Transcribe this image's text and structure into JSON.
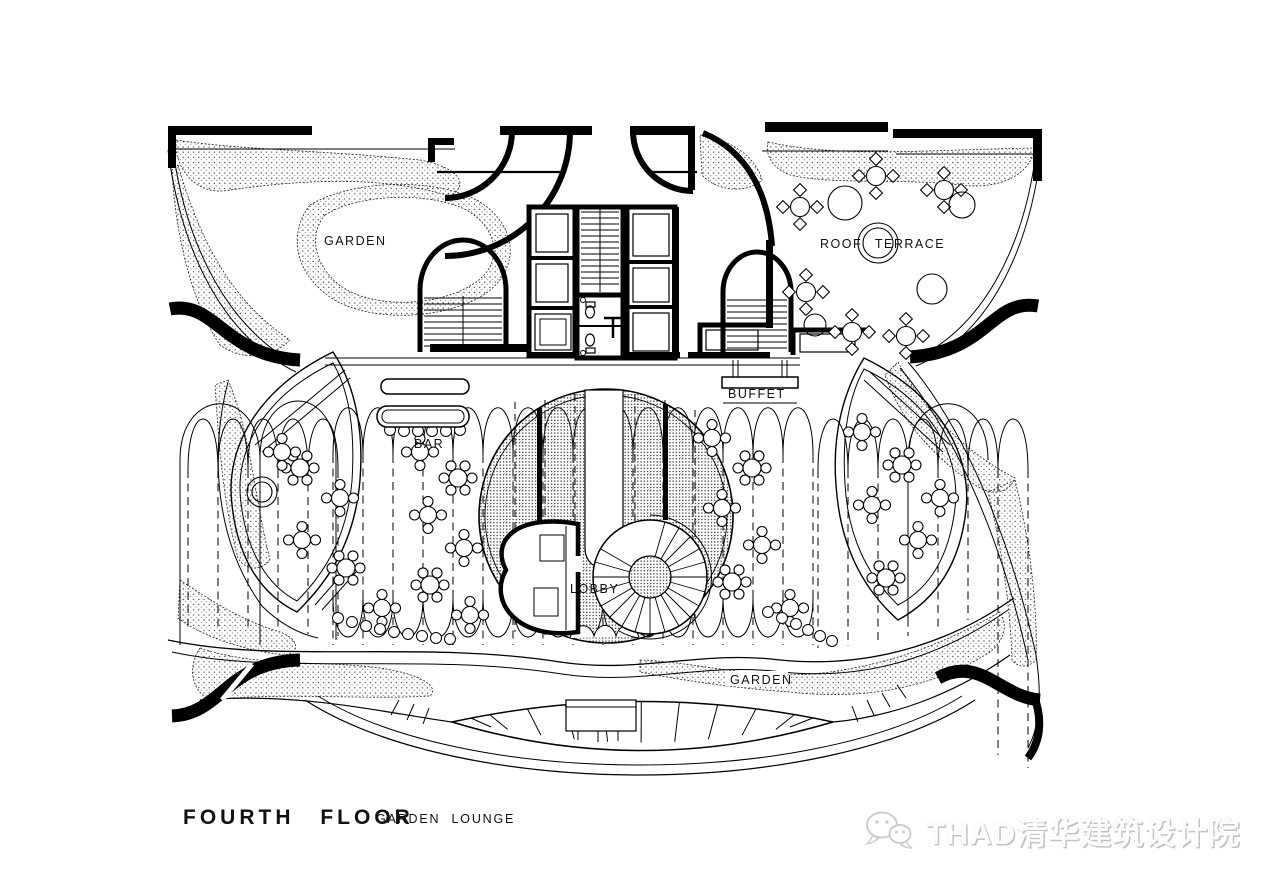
{
  "drawing": {
    "title": "FOURTH FLOOR",
    "subtitle": "GARDEN LOUNGE",
    "labels": {
      "garden_top": "GARDEN",
      "roof_terrace": "ROOF TERRACE",
      "buffet": "BUFFET",
      "bar": "BAR",
      "lobby": "LOBBY",
      "garden_bottom": "GARDEN"
    },
    "colors": {
      "ink": "#000000",
      "paper": "#ffffff",
      "watermark_gray": "#c3c3c3"
    }
  },
  "watermark": {
    "text": "THAD清华建筑设计院",
    "icon": "wechat-icon"
  }
}
